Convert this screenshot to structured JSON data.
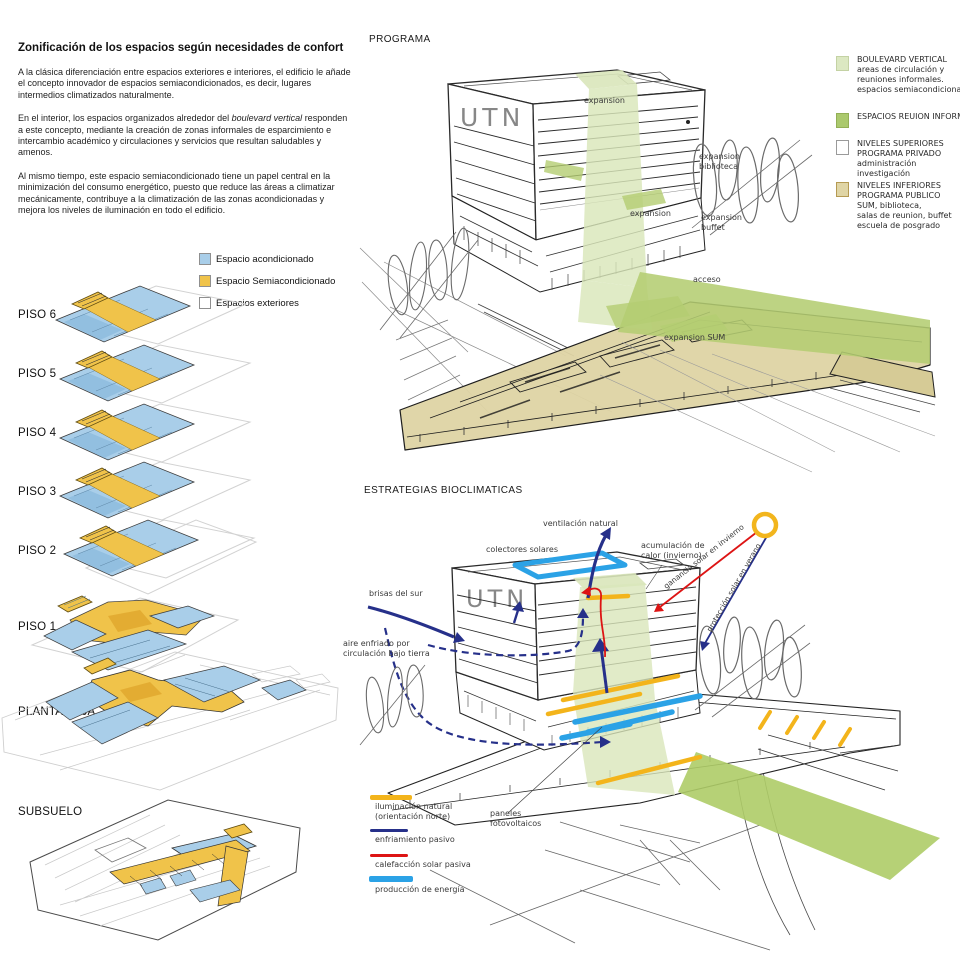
{
  "colors": {
    "plan_blue": "#a9cee9",
    "plan_blue_dark": "#7fb2d8",
    "plan_yellow": "#f0c34a",
    "boulevard_light_green": "#d9e6ba",
    "mid_green": "#b4cd72",
    "tan_podium": "#ded4a4",
    "navy_arrow": "#26308a",
    "red_arrow": "#dd1414",
    "sky_blue": "#2ba2e6",
    "bar_yellow": "#f3b41b",
    "sun_yellow": "#f2b51d"
  },
  "left_panel": {
    "title": "Zonificación de los espacios según necesidades de confort",
    "para1": "A la clásica diferenciación entre espacios exteriores e interiores, el edificio le añade el concepto innovador de espacios semiacondicionados, es decir, lugares intermedios climatizados naturalmente.",
    "para2_before": "En el interior, los espacios organizados alrededor del ",
    "para2_italic": "boulevard vertical",
    "para2_after": " responden a este concepto, mediante la creación de zonas informales de esparcimiento e intercambio académico y circulaciones y servicios que resultan saludables y amenos.",
    "para3": "Al mismo tiempo, este espacio semiacondicionado tiene un papel central en la minimización del consumo energético, puesto que reduce las áreas a climatizar mecánicamente, contribuye a la climatización de las zonas acondicionadas y mejora los niveles de iluminación en todo el edificio.",
    "legend": {
      "acond": "Espacio acondicionado",
      "semi": "Espacio Semiacondicionado",
      "ext": "Espacios exteriores"
    },
    "floors": {
      "p6": "PISO 6",
      "p5": "PISO 5",
      "p4": "PISO 4",
      "p3": "PISO 3",
      "p2": "PISO 2",
      "p1": "PISO 1",
      "pb": "PLANTA BAJA",
      "sub": "SUBSUELO"
    }
  },
  "programa": {
    "title": "PROGRAMA",
    "building_label": "UTN",
    "legend": {
      "item1": "BOULEVARD VERTICAL\nareas de circulación y\nreuniones informales.\nespacios semiacondicionados",
      "item2": "ESPACIOS REUION INFORMAL",
      "item3": "NIVELES SUPERIORES\nPROGRAMA PRIVADO\nadministración\ninvestigación",
      "item4": "NIVELES INFERIORES\nPROGRAMA PUBLICO\nSUM, biblioteca,\nsalas de reunion, buffet\nescuela de posgrado"
    },
    "ann": {
      "expansion_top": "expansion",
      "expansion_biblioteca": "expansion\nbiblioteca",
      "expansion_mid": "expansion",
      "expansion_buffet": "expansion\nbuffet",
      "acceso": "acceso",
      "expansion_sum": "expansion SUM"
    }
  },
  "estrategias": {
    "title": "ESTRATEGIAS BIOCLIMATICAS",
    "building_label": "UTN",
    "ann": {
      "ventilacion": "ventilación natural",
      "colectores": "colectores solares",
      "acumulacion": "acumulación de\ncalor (invierno)",
      "ganancia": "ganancia solar en invierno",
      "proteccion": "protección solar en verano",
      "brisas": "brisas del sur",
      "aire": "aire enfriado por\ncirculación bajo tierra",
      "paneles": "paneles\nfotovoltaicos"
    },
    "legend": {
      "l1": "iluminación natural\n(orientación norte)",
      "l2": "enfriamiento pasivo",
      "l3": "calefacción solar pasiva",
      "l4": "producción de energía"
    }
  }
}
